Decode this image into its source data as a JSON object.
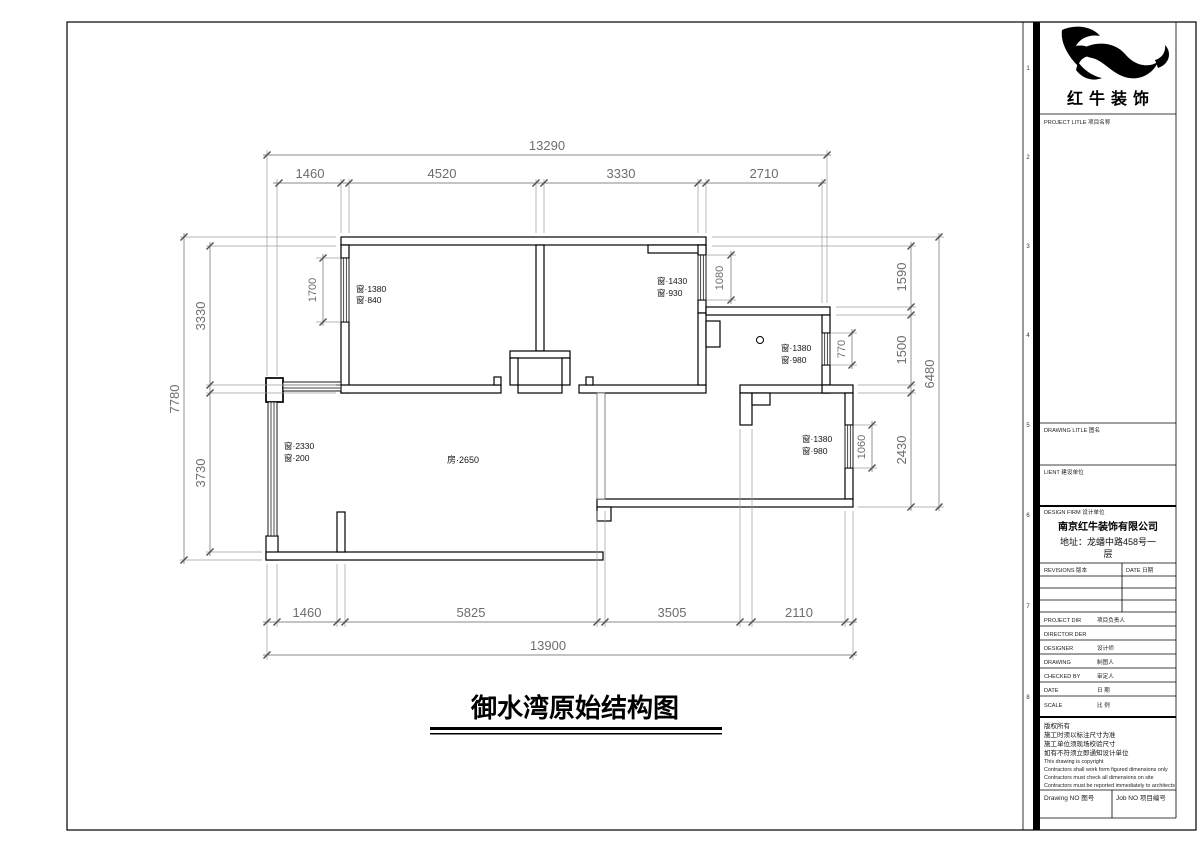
{
  "page": {
    "title": "御水湾原始结构图",
    "zone_markers": [
      "1",
      "2",
      "3",
      "4",
      "5",
      "6",
      "7",
      "8"
    ],
    "colors": {
      "paper": "#ffffff",
      "line": "#000000",
      "dimension": "#8a8a8a"
    }
  },
  "plan": {
    "room_label": "房·2650",
    "dims": {
      "top_overall": "13290",
      "top_seg_0": "1460",
      "top_seg_1": "4520",
      "top_seg_2": "3330",
      "top_seg_3": "2710",
      "bottom_overall": "13900",
      "bottom_seg_0": "1460",
      "bottom_seg_1": "5825",
      "bottom_seg_2": "3505",
      "bottom_seg_3": "2110",
      "left_overall": "7780",
      "left_seg_0": "3330",
      "left_seg_1": "3730",
      "right_overall": "6480",
      "right_seg_0": "1590",
      "right_seg_1": "1500",
      "right_seg_2": "2430",
      "window_left": "1700",
      "window_top_right": "1080",
      "window_small_room": "770",
      "window_lower_right": "1060"
    },
    "windows": {
      "w1a": "窗·1380",
      "w1b": "窗·840",
      "w2a": "窗·1430",
      "w2b": "窗·930",
      "w3a": "窗·1380",
      "w3b": "窗·980",
      "w4a": "窗·1380",
      "w4b": "窗·980",
      "w5a": "窗·2330",
      "w5b": "窗·200"
    }
  },
  "titleblock": {
    "brand": "红牛装饰",
    "project_title": "PROJECT LITLE  项目名称",
    "drawing_title": "DRAWING LITLE  图名",
    "client": "LIENT  建设单位",
    "design_firm": "DESIGN FIRM  设计单位",
    "company_name": "南京红牛装饰有限公司",
    "address_1": "地址：龙蟠中路458号一",
    "address_2": "层",
    "revisions": "REVISIONS  版本",
    "date_col": "DATE  日期",
    "rows": [
      {
        "en": "PROJECT DIR",
        "cn": "项目负责人"
      },
      {
        "en": "DIRECTOR DER",
        "cn": ""
      },
      {
        "en": "DESIGNER",
        "cn": "设计师"
      },
      {
        "en": "DRAWING",
        "cn": "制图人"
      },
      {
        "en": "CHECKED BY",
        "cn": "审定人"
      },
      {
        "en": "DATE",
        "cn": "日 期"
      },
      {
        "en": "SCALE",
        "cn": "比 例"
      }
    ],
    "copyright": [
      "版权所有",
      "施工时须以标注尺寸为准",
      "施工单位须现场校验尺寸",
      "如有不符须立即通知设计单位",
      "This drawing is copyright",
      "Contractors shall work form figured dimensions only",
      "Contractors must check all dimensions on site",
      "Contractors must be reported immediately to architects"
    ],
    "drawing_no": "Drawing NO  图号",
    "job_no": "Job NO  项目编号"
  }
}
